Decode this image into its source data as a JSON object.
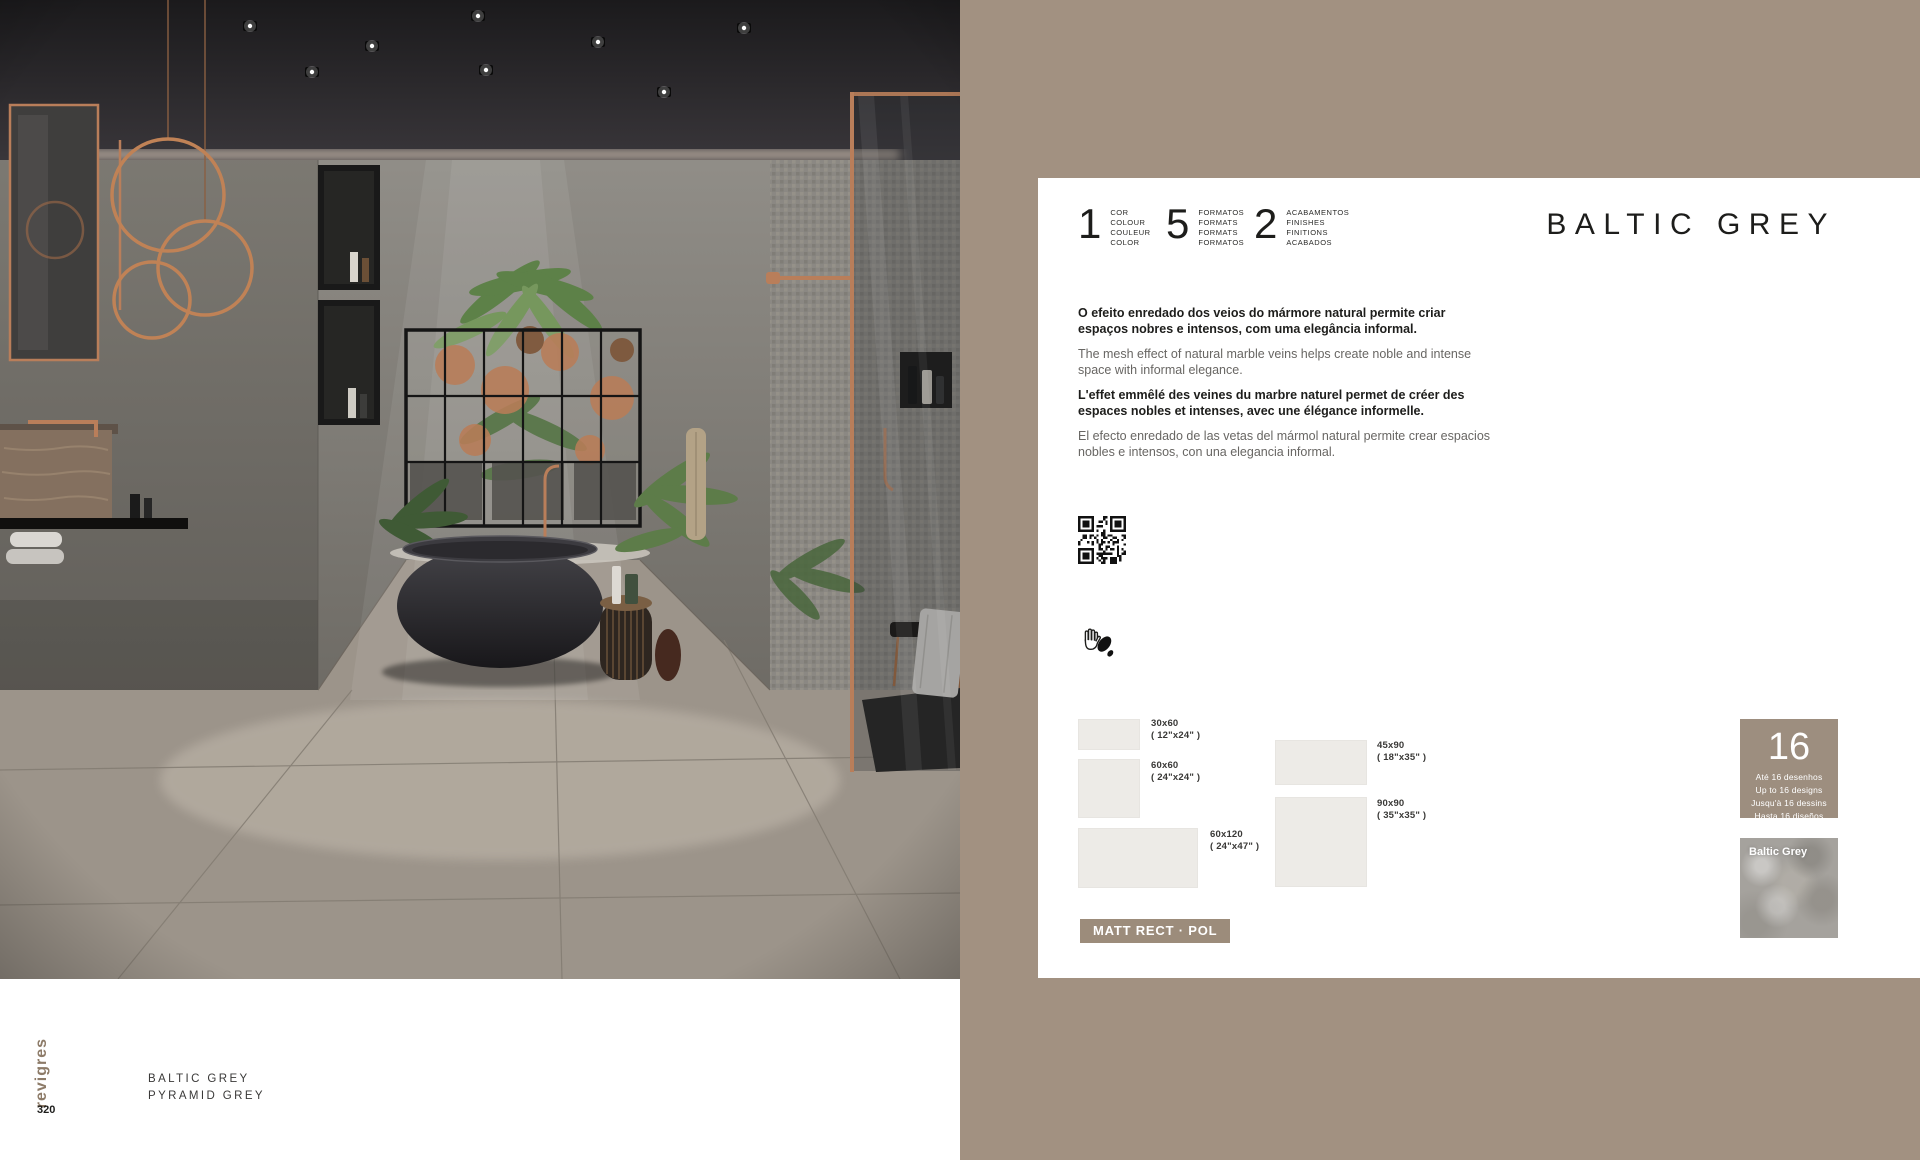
{
  "colors": {
    "background_taupe": "#a29181",
    "card_white": "#ffffff",
    "badge_taupe": "#9c8c7b",
    "designs_box_taupe": "#9d8e7f",
    "text_dark": "#1d1d1b",
    "text_grey": "#686663",
    "brand_brown": "#8d7b68",
    "swatch_grey": "#a5a29d",
    "copper_accent": "#b97e5a"
  },
  "card": {
    "title": "BALTIC GREY",
    "specs": [
      {
        "num": "1",
        "labels": [
          "COR",
          "COLOUR",
          "COULEUR",
          "COLOR"
        ]
      },
      {
        "num": "5",
        "labels": [
          "FORMATOS",
          "FORMATS",
          "FORMATS",
          "FORMATOS"
        ]
      },
      {
        "num": "2",
        "labels": [
          "ACABAMENTOS",
          "FINISHES",
          "FINITIONS",
          "ACABADOS"
        ]
      }
    ],
    "paragraphs": [
      {
        "lang": "pt",
        "bold": true,
        "text": "O efeito enredado dos veios do mármore natural permite criar espaços nobres e intensos, com uma elegância informal."
      },
      {
        "lang": "en",
        "bold": false,
        "text": "The mesh effect of natural marble veins helps create noble and intense space with informal elegance."
      },
      {
        "lang": "fr",
        "bold": true,
        "text": "L'effet emmêlé des veines du marbre naturel permet de créer des espaces nobles et intenses, avec une élégance informelle."
      },
      {
        "lang": "es",
        "bold": false,
        "text": "El efecto enredado de las vetas del mármol natural permite crear espacios nobles e intensos, con una elegancia informal."
      }
    ],
    "formats": [
      {
        "size": "30x60",
        "inches": "( 12\"x24\" )"
      },
      {
        "size": "60x60",
        "inches": "( 24\"x24\" )"
      },
      {
        "size": "60x120",
        "inches": "( 24\"x47\" )"
      },
      {
        "size": "45x90",
        "inches": "( 18\"x35\" )"
      },
      {
        "size": "90x90",
        "inches": "( 35\"x35\" )"
      }
    ],
    "finish_badge": "MATT RECT · POL",
    "designs": {
      "number": "16",
      "lines": [
        "Até 16 desenhos",
        "Up to 16 designs",
        "Jusqu'à 16 dessins",
        "Hasta 16 diseños"
      ]
    },
    "swatch": {
      "label": "Baltic Grey"
    }
  },
  "footer": {
    "brand": "revigres",
    "page": "320",
    "products": [
      "BALTIC GREY",
      "PYRAMID GREY"
    ]
  }
}
